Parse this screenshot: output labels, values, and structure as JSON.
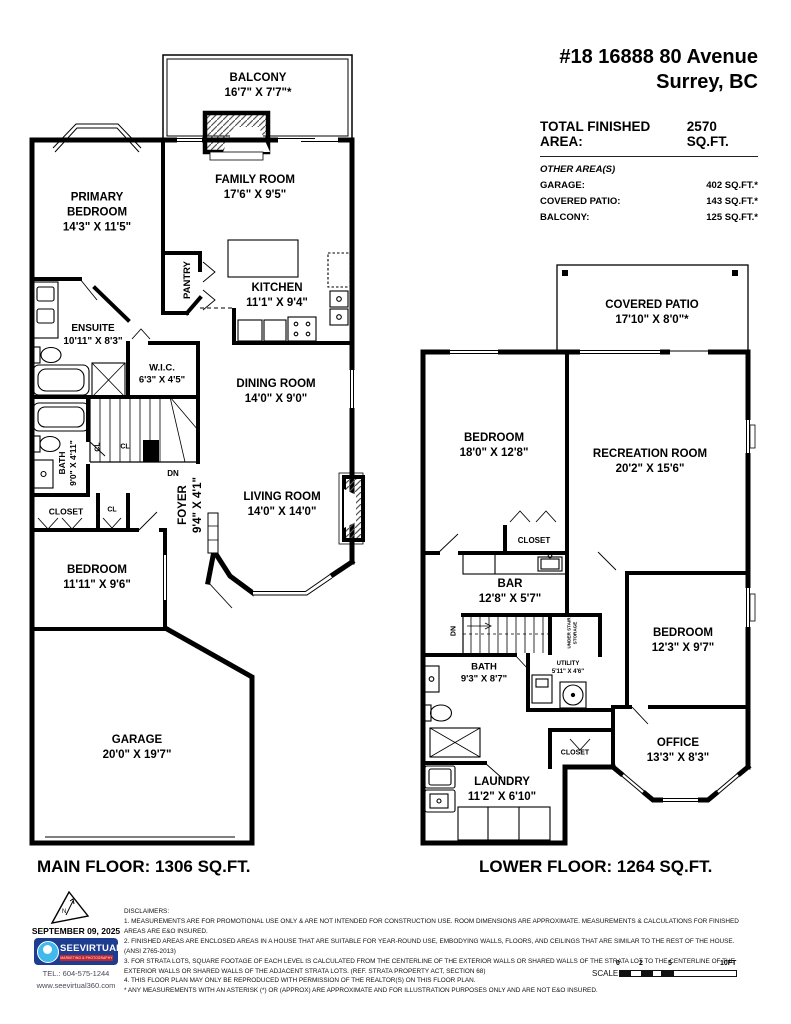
{
  "header": {
    "address_line1": "#18 16888 80 Avenue",
    "address_line2": "Surrey, BC",
    "total_area_label": "TOTAL FINISHED AREA:",
    "total_area_value": "2570 SQ.FT.",
    "other_areas_title": "OTHER AREA(S)",
    "other_areas": [
      {
        "label": "GARAGE:",
        "value": "402 SQ.FT.*"
      },
      {
        "label": "COVERED PATIO:",
        "value": "143 SQ.FT.*"
      },
      {
        "label": "BALCONY:",
        "value": "125 SQ.FT.*"
      }
    ]
  },
  "main_floor": {
    "title": "MAIN FLOOR: 1306 SQ.FT.",
    "rooms": {
      "balcony": {
        "name": "BALCONY",
        "dims": "16'7\" X 7'7\"*"
      },
      "primary_bedroom": {
        "name": "PRIMARY BEDROOM",
        "dims": "14'3\" X 11'5\""
      },
      "family_room": {
        "name": "FAMILY ROOM",
        "dims": "17'6\" X 9'5\""
      },
      "pantry": {
        "name": "PANTRY"
      },
      "kitchen": {
        "name": "KITCHEN",
        "dims": "11'1\" X 9'4\""
      },
      "ensuite": {
        "name": "ENSUITE",
        "dims": "10'11\" X 8'3\""
      },
      "wic": {
        "name": "W.I.C.",
        "dims": "6'3\" X 4'5\""
      },
      "dining_room": {
        "name": "DINING ROOM",
        "dims": "14'0\" X 9'0\""
      },
      "bath": {
        "name": "BATH",
        "dims": "9'0\" X 4'11\""
      },
      "closet_cl_1": {
        "name": "CL"
      },
      "closet_cl_2": {
        "name": "CL"
      },
      "closet_cl_3": {
        "name": "CL"
      },
      "stairs_dn": {
        "name": "DN"
      },
      "foyer": {
        "name": "FOYER",
        "dims": "9'4\" X 4'1\""
      },
      "closet": {
        "name": "CLOSET"
      },
      "living_room": {
        "name": "LIVING ROOM",
        "dims": "14'0\" X 14'0\""
      },
      "bedroom": {
        "name": "BEDROOM",
        "dims": "11'11\" X 9'6\""
      },
      "garage": {
        "name": "GARAGE",
        "dims": "20'0\" X 19'7\""
      }
    }
  },
  "lower_floor": {
    "title": "LOWER FLOOR: 1264 SQ.FT.",
    "rooms": {
      "covered_patio": {
        "name": "COVERED PATIO",
        "dims": "17'10\" X 8'0\"*"
      },
      "bedroom_1": {
        "name": "BEDROOM",
        "dims": "18'0\" X 12'8\""
      },
      "recreation_room": {
        "name": "RECREATION ROOM",
        "dims": "20'2\" X 15'6\""
      },
      "closet_1": {
        "name": "CLOSET"
      },
      "bar": {
        "name": "BAR",
        "dims": "12'8\" X 5'7\""
      },
      "stairs_dn": {
        "name": "DN"
      },
      "under_stair_storage": {
        "name": "UNDER STAIR STORAGE"
      },
      "bedroom_2": {
        "name": "BEDROOM",
        "dims": "12'3\" X 9'7\""
      },
      "bath": {
        "name": "BATH",
        "dims": "9'3\" X 8'7\""
      },
      "utility": {
        "name": "UTILITY",
        "dims": "5'11\" X 4'6\""
      },
      "office": {
        "name": "OFFICE",
        "dims": "13'3\" X 8'3\""
      },
      "closet_2": {
        "name": "CLOSET"
      },
      "laundry": {
        "name": "LAUNDRY",
        "dims": "11'2\" X 6'10\""
      }
    }
  },
  "footer": {
    "date": "SEPTEMBER 09, 2025",
    "compass_letter": "N",
    "logo_text": "SEEVIRTUAL",
    "logo_subtext": "MARKETING & PHOTOGRAPHY",
    "tel": "TEL.: 604-575-1244",
    "website": "www.seevirtual360.com",
    "disclaimers_title": "DISCLAIMERS:",
    "disclaimers": [
      "1. MEASUREMENTS ARE FOR PROMOTIONAL USE ONLY & ARE NOT INTENDED FOR CONSTRUCTION USE. ROOM DIMENSIONS ARE APPROXIMATE. MEASUREMENTS & CALCULATIONS FOR FINISHED AREAS ARE E&O INSURED.",
      "2. FINISHED AREAS ARE ENCLOSED AREAS IN A HOUSE THAT ARE SUITABLE FOR YEAR-ROUND USE, EMBODYING WALLS, FLOORS, AND CEILINGS THAT ARE SIMILAR TO THE REST OF THE HOUSE. (ANSI Z765-2013)",
      "3. FOR STRATA LOTS, SQUARE FOOTAGE OF EACH LEVEL IS CALCULATED FROM THE CENTERLINE OF THE EXTERIOR WALLS OR SHARED WALLS OF THE STRATA LOT TO THE CENTERLINE OF THE EXTERIOR WALLS OR SHARED WALLS OF THE ADJACENT STRATA LOTS. (REF. STRATA PROPERTY ACT, SECTION 68)",
      "4. THIS FLOOR PLAN MAY ONLY BE REPRODUCED WITH PERMISSION OF THE REALTOR(S) ON THIS FLOOR PLAN.",
      "* ANY MEASUREMENTS WITH AN ASTERISK (*) OR (APPROX) ARE APPROXIMATE AND FOR ILLUSTRATION PURPOSES ONLY AND ARE NOT E&O INSURED."
    ],
    "scale_label": "SCALE",
    "scale_ticks": [
      "0",
      "2",
      "5",
      "10FT"
    ]
  },
  "colors": {
    "wall": "#000000",
    "logo_blue": "#1d3d91",
    "logo_light_blue": "#41b9ea",
    "logo_red": "#c2242b"
  }
}
